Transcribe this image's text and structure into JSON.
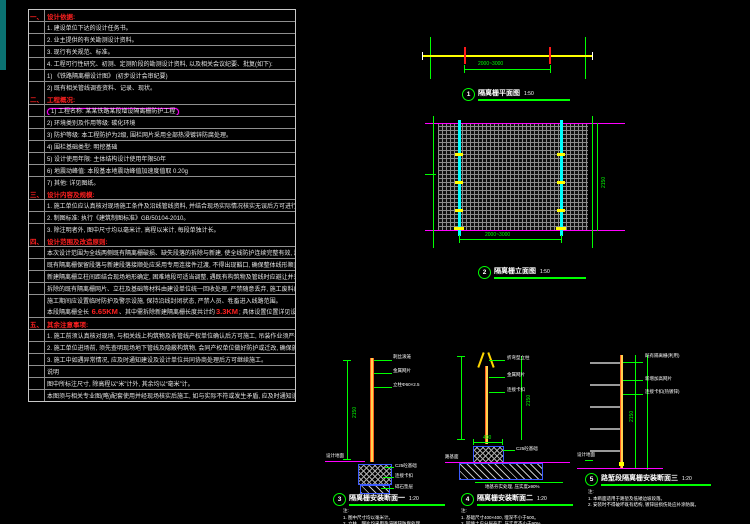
{
  "notes_panel": {
    "sections": [
      {
        "num": "一、",
        "title": "设计依据:",
        "rows": [
          {
            "text": "1. 建设单位下达的设计任务书。"
          },
          {
            "text": "2. 业主提供的有关勘测设计资料。"
          },
          {
            "text": "3. 现行有关规范、标准。"
          },
          {
            "text": "4. 工程可行性研究、初测、定测阶段的勘测设计资料, 以及相关会议纪要、批复(如下):"
          },
          {
            "text": "1) 《铁路隔离栅设计图》 (初步设计会审纪要)"
          },
          {
            "text": "2) 既有相关管线调查资料、记录、现状。"
          }
        ]
      },
      {
        "num": "二、",
        "title": "工程概况:",
        "rows": [
          {
            "text": "1) 工程名称: 某某铁路某段增设隔离栅防护工程",
            "cloud": true
          },
          {
            "text": "2) 环境类别及作用等级: 碳化环境"
          },
          {
            "text": "3) 防护等级: 本工程防护为2级, 围栏网片采用全部热浸镀锌防腐处理。"
          },
          {
            "text": "4) 围栏基础类型: 明挖基础"
          },
          {
            "text": "5) 设计使用年限: 主体结构设计使用年限50年"
          },
          {
            "text": "6) 地震动峰值: 本段基本地震动峰值加速度值取 0.20g"
          },
          {
            "text": "7) 其他: 详见图纸。"
          }
        ]
      },
      {
        "num": "三、",
        "title": "设计内容及规模:",
        "rows": [
          {
            "text": "1. 施工单位应认真核对现场施工条件及沿线管线资料, 并结合现场实际情况核实无误后方可进行施工。"
          },
          {
            "text": "2. 制图标准: 执行《建筑制图标准》GB/50104-2010。"
          },
          {
            "text": "3. 除注明者外, 图中尺寸均以毫米计, 高程以米计, 每段单独计长。"
          }
        ]
      },
      {
        "num": "四、",
        "title": "设计范围及改造原则:",
        "rows": [
          {
            "text": "本次设计范围为全线两侧既有隔离栅破损、缺失段落的拆除与新建, 使全线防护连续完整有效, 满足铁路沿线封闭管理要求, 并兼顾与既有段落的衔接顺适。"
          },
          {
            "text": "既有隔离栅保留段落与新建段落接顺处应采用专用连接件过渡, 不得出现豁口, 确保整体线形顺直、高度一致, 过渡段不得小于一档, 以保证封闭防护效果。"
          },
          {
            "text": "新建隔离栅立柱间距结合现场地形确定, 困难地段可适当调整, 遇既有构筑物及管线时应避让并采取相应防护措施, 避免施工对既有设施造成破坏及干扰。"
          },
          {
            "text": "拆除的既有隔离栅网片、立柱及基础等材料由建设单位统一回收处理, 严禁随意丢弃, 施工废料应及时清运, 保持线路环境整洁。"
          },
          {
            "text": "施工期间应设置临时防护及警示设施, 保持沿线封闭状态, 严禁人员、牲畜进入线路范围。"
          }
        ]
      },
      {
        "num": "五、",
        "title": "其余注意事项:",
        "rows": [
          {
            "text": "1. 施工前须认真核对现场, 与相关线上构筑物及各管线产权单位确认后方可施工, 吊装作业须严格执行相关安全规定, 严禁侵入既有线建筑限界。"
          },
          {
            "text": "2. 施工单位进场前, 须先查明现场地下管线及隐蔽构筑物, 会同产权单位做好防护或迁改, 确保施工安全。"
          },
          {
            "text": "3. 施工中如遇异常情况, 应及时通知建设及设计单位共同协商处理后方可继续施工。"
          },
          {
            "text": "说明"
          },
          {
            "text": "图中所标注尺寸, 除高程以“米”计外, 其余均以“毫米”计。"
          },
          {
            "text": "本图须与相关专业图(略)配套使用并经现场核实后施工, 如与实际不符或发生矛盾, 应及时通知设计单位(略)研究处理后方可继续按图施工。"
          }
        ]
      }
    ],
    "km_row": {
      "pre": "本段隔离栅全长 ",
      "km1": "6.65KM",
      "mid": "、其中需拆除新建隔离栅长度共计约",
      "km2": "3.3KM",
      "post": "; 具体设置位置详见设计平面图。"
    }
  },
  "drawings": {
    "plan": {
      "number": "1",
      "title": "隔离栅平面图",
      "scale": "1:50",
      "dim_span": "2000~3000"
    },
    "elevation": {
      "number": "2",
      "title": "隔离栅立面图",
      "scale": "1:50",
      "dim_span": "2000~3000",
      "dim_height": "2150"
    },
    "section_a": {
      "number": "3",
      "title": "隔离栅安装断面一",
      "scale": "1:20",
      "dim_height": "2150",
      "labels": {
        "top": "刺丝滚笼",
        "l1": "金属网片",
        "l2": "立柱Φ60×2.5",
        "ground": "设计地面",
        "f1": "C25砼基础",
        "f2": "连接卡扣",
        "f3": "碎石垫层"
      },
      "notes": [
        "注:",
        "1. 图中尺寸均以毫米计。",
        "2. 立柱、网片均采用热浸镀锌防腐处理。"
      ]
    },
    "section_b": {
      "number": "4",
      "title": "隔离栅安装断面二",
      "scale": "1:20",
      "dim_height": "2150",
      "dim_width": "400",
      "labels": {
        "top": "折弯型立柱",
        "l1": "金属网片",
        "l2": "连接卡扣",
        "ground": "路基面",
        "f1": "C25砼基础",
        "f3": "地基夯实处理, 压实度≥90%"
      },
      "notes": [
        "注:",
        "1. 基础尺寸400×400, 埋深不小于500。",
        "2. 回填土应分层夯实, 压实度不小于90%。"
      ]
    },
    "section_c": {
      "number": "5",
      "title": "路堑段隔离栅安装断面三",
      "scale": "1:20",
      "dim_height": "2150",
      "labels": {
        "l1": "既有隔离栅(利用)",
        "l2": "新增加高网片",
        "l3": "连接卡扣(热镀锌)",
        "ground": "设计地面"
      },
      "notes": [
        "注:",
        "1. 本断面适用于路堑及低矮边坡段落。",
        "2. 安装时不得破坏既有结构, 镀锌层损伤处应补涂防腐。"
      ]
    }
  }
}
